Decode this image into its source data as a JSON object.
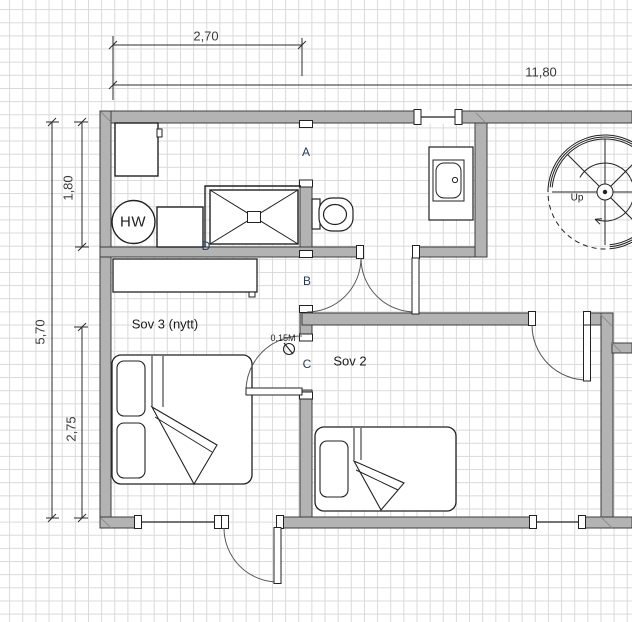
{
  "floorplan": {
    "dimensions": {
      "bath_width": "2,70",
      "total_width": "11,80",
      "bath_height": "1,80",
      "total_height": "5,70",
      "sov3_height": "2,75",
      "offset_note": "0,15M"
    },
    "rooms": {
      "sov3_label": "Sov 3 (nytt)",
      "sov2_label": "Sov 2"
    },
    "fixtures": {
      "water_heater_label": "HW",
      "stair_label": "Up"
    },
    "openings": {
      "a": "A",
      "b": "B",
      "c": "C",
      "d": "D"
    },
    "colors": {
      "wall_fill": "#b3b3b3",
      "wall_outline": "#3c3c3c",
      "grid": "#d9d9d9",
      "door_label": "#1f3a5f",
      "line": "#2b2b2b",
      "background": "#ffffff"
    }
  }
}
